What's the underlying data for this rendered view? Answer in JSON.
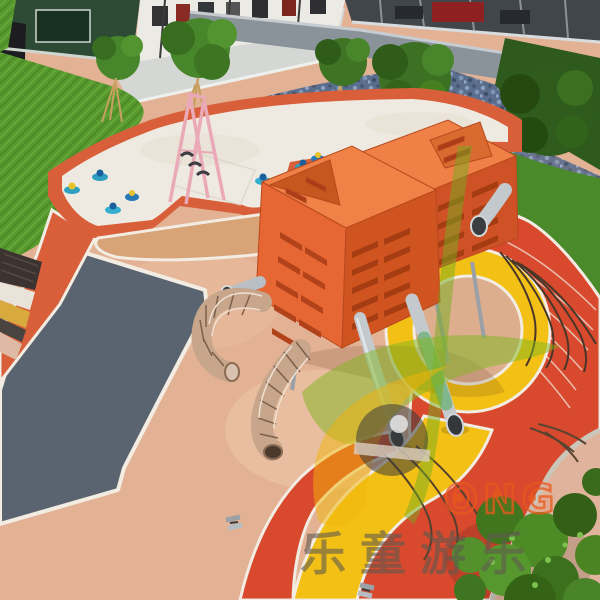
{
  "watermark": {
    "brand_latin": "ONG",
    "brand_cjk": "乐童游乐",
    "logo_colors": {
      "leaf_green": "#7fb61f",
      "swoosh_yellow": "#f2b60a",
      "disc_grey": "#3b3b3b",
      "letter_orange": "#e8581c",
      "text_grey": "#5f594f"
    }
  },
  "palette": {
    "surfacing_tan": "#e3b295",
    "surfacing_red": "#d8492e",
    "surfacing_orange_red": "#d85f3a",
    "surfacing_yellow": "#f3c116",
    "surfacing_grey": "#5a6470",
    "curb_white": "#f2ece2",
    "sand_white": "#efeae1",
    "lawn_green": "#5d9f33",
    "field_grass_green": "#4a8a2b",
    "hedge_green": "#2e5a1e",
    "flowerbed_blue": "#5a6d8d",
    "equipment_orange": "#e86a32",
    "equipment_orange_dark": "#cf5226",
    "slide_steel": "#c3c9cd",
    "net_copper": "#c7a68c",
    "frame_pink": "#eaa9b6",
    "rider_teal": "#2f9fc0"
  },
  "scene": {
    "objects": [
      "perimeter-building",
      "poster-display-wall",
      "storefront-glazing",
      "granite-wall",
      "artificial-lawn",
      "flower-bed",
      "landscape-trees",
      "white-sand-play-area",
      "pink-swing-frame",
      "spring-riders",
      "orange-play-cube-front",
      "orange-play-cube-rear",
      "stainless-tube-slides",
      "wire-net-tunnels",
      "climbing-ropes",
      "epdm-rubber-surfacing",
      "grey-chevron-path",
      "running-track-lines",
      "corner-shrub",
      "ground-anchors"
    ]
  }
}
